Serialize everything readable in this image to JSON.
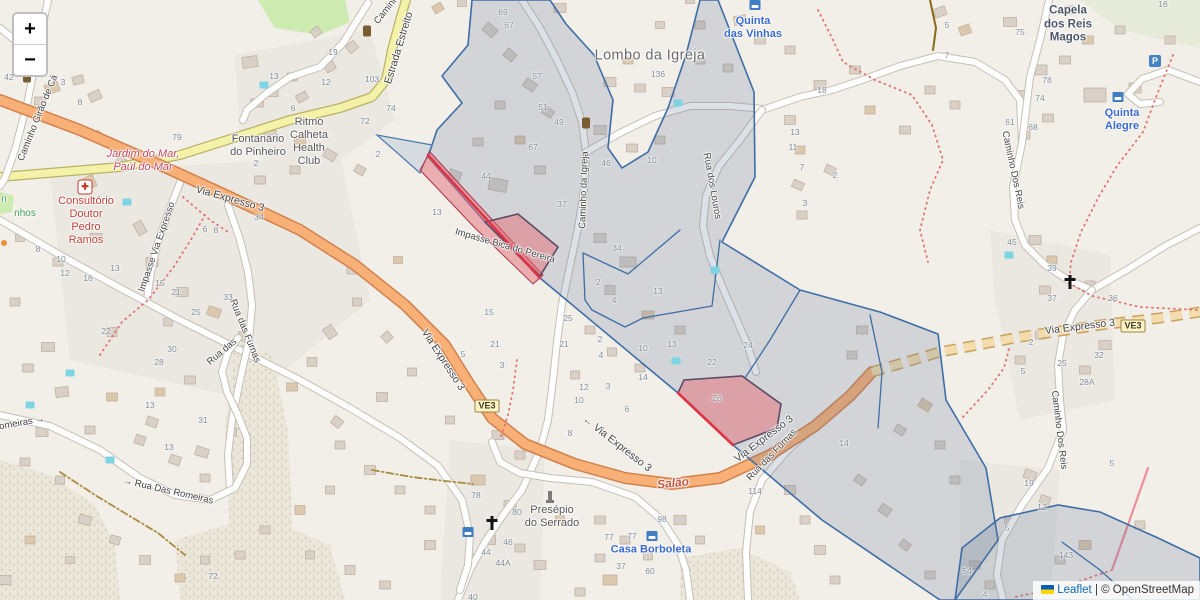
{
  "map_colors": {
    "land": "#f2efe9",
    "overlay_fill": "rgba(96,118,148,0.22)",
    "overlay_stroke": "#3e6da6",
    "flag_fill": "rgba(228,110,120,0.50)",
    "flag_stroke": "#5c4a66",
    "flag_red_edge": "#e03445",
    "trunk_road": "#f8b076",
    "secondary_road": "#f4f2a9",
    "trail_red": "#e4706e",
    "track_tan": "#a98a3f"
  },
  "zoom_control": {
    "zoom_in": "+",
    "zoom_out": "−"
  },
  "attribution": {
    "leaflet": "Leaflet",
    "separator": " | ",
    "copyright": "© OpenStreetMap"
  },
  "road_badges": [
    {
      "text": "VE3",
      "x": 487,
      "y": 406
    },
    {
      "text": "VE3",
      "x": 1133,
      "y": 326
    }
  ],
  "labels": [
    {
      "text": "Lombo da Igreja",
      "x": 650,
      "y": 56,
      "rot": 0,
      "cls": "place"
    },
    {
      "text": "Quinta\ndas Vinhas",
      "x": 753,
      "y": 28,
      "rot": 0,
      "cls": "poi-blue"
    },
    {
      "text": "Capela\ndos Reis\nMagos",
      "x": 1068,
      "y": 25,
      "rot": 0,
      "cls": "poi-dark"
    },
    {
      "text": "Quinta\nAlegre",
      "x": 1122,
      "y": 120,
      "rot": 0,
      "cls": "poi-blue"
    },
    {
      "text": "Casa Borboleta",
      "x": 651,
      "y": 550,
      "rot": 0,
      "cls": "poi-blue"
    },
    {
      "text": "Consultório\nDoutor\nPedro\nRamos",
      "x": 86,
      "y": 221,
      "rot": 0,
      "cls": "poi-red"
    },
    {
      "text": "Jardim do Mar,\nPaúl do Mar",
      "x": 143,
      "y": 161,
      "rot": 0,
      "cls": "boundary"
    },
    {
      "text": "Salão",
      "x": 673,
      "y": 483,
      "rot": -6,
      "cls": "locality"
    },
    {
      "text": "Presépio\ndo Serrado",
      "x": 552,
      "y": 517,
      "rot": 0,
      "cls": "poi-gray"
    },
    {
      "text": "Ritmo\nCalheta\nHealth\nClub",
      "x": 309,
      "y": 142,
      "rot": 0,
      "cls": "poi-gray"
    },
    {
      "text": "Fontanário\ndo Pinheiro",
      "x": 258,
      "y": 146,
      "rot": 0,
      "cls": "poi-gray"
    },
    {
      "text": "n",
      "x": 4,
      "y": 200,
      "rot": 0,
      "cls": "path-green"
    },
    {
      "text": "nhos",
      "x": 25,
      "y": 214,
      "rot": 0,
      "cls": "path-green"
    },
    {
      "text": "Caminho Girão de Cá",
      "x": 38,
      "y": 118,
      "rot": -68,
      "cls": "road"
    },
    {
      "text": "Caminho",
      "x": 388,
      "y": 8,
      "rot": -52,
      "cls": "road"
    },
    {
      "text": "Estrada Estreito",
      "x": 399,
      "y": 48,
      "rot": -73,
      "cls": "road road-lg"
    },
    {
      "text": "Via Expresso 3",
      "x": 230,
      "y": 199,
      "rot": 16,
      "cls": "road road-lg"
    },
    {
      "text": "Impasse Via Expresso",
      "x": 157,
      "y": 247,
      "rot": -71,
      "cls": "road"
    },
    {
      "text": "Via Expresso 3",
      "x": 443,
      "y": 360,
      "rot": 57,
      "cls": "road road-lg"
    },
    {
      "text": "← Via Expresso 3",
      "x": 617,
      "y": 444,
      "rot": 38,
      "cls": "road road-lg"
    },
    {
      "text": "Via Expresso 3",
      "x": 764,
      "y": 439,
      "rot": -37,
      "cls": "road road-lg"
    },
    {
      "text": "Via Expresso 3",
      "x": 1080,
      "y": 327,
      "rot": -7,
      "cls": "road road-lg"
    },
    {
      "text": "Impasse Bica do Pereira",
      "x": 505,
      "y": 246,
      "rot": 16,
      "cls": "road"
    },
    {
      "text": "Caminho da Igreja",
      "x": 584,
      "y": 190,
      "rot": -88,
      "cls": "road"
    },
    {
      "text": "Rua dos Louros",
      "x": 712,
      "y": 186,
      "rot": 80,
      "cls": "road"
    },
    {
      "text": "Caminho Dos Reis",
      "x": 1013,
      "y": 170,
      "rot": 78,
      "cls": "road"
    },
    {
      "text": "Caminho Dos Reis",
      "x": 1059,
      "y": 430,
      "rot": 83,
      "cls": "road"
    },
    {
      "text": "Rua das Furnas",
      "x": 245,
      "y": 331,
      "rot": 68,
      "cls": "road"
    },
    {
      "text": "Rua das Furnas",
      "x": 772,
      "y": 455,
      "rot": -46,
      "cls": "road"
    },
    {
      "text": "→ Rua Das Romeiras",
      "x": 168,
      "y": 491,
      "rot": 13,
      "cls": "road"
    },
    {
      "text": "omeiras →",
      "x": 22,
      "y": 423,
      "rot": -10,
      "cls": "road"
    },
    {
      "text": "Rua das",
      "x": 222,
      "y": 352,
      "rot": -40,
      "cls": "road"
    }
  ],
  "house_numbers": [
    [
      9,
      77,
      "42"
    ],
    [
      63,
      82,
      "3"
    ],
    [
      80,
      102,
      "8"
    ],
    [
      177,
      137,
      "79"
    ],
    [
      256,
      163,
      "2"
    ],
    [
      274,
      76,
      "13"
    ],
    [
      293,
      108,
      "6"
    ],
    [
      333,
      52,
      "19"
    ],
    [
      326,
      82,
      "12"
    ],
    [
      372,
      79,
      "103"
    ],
    [
      391,
      108,
      "74"
    ],
    [
      365,
      121,
      "72"
    ],
    [
      378,
      154,
      "2"
    ],
    [
      503,
      12,
      "69"
    ],
    [
      509,
      25,
      "67"
    ],
    [
      537,
      76,
      "57"
    ],
    [
      543,
      107,
      "51"
    ],
    [
      559,
      122,
      "49"
    ],
    [
      533,
      147,
      "67"
    ],
    [
      658,
      74,
      "136"
    ],
    [
      606,
      163,
      "46"
    ],
    [
      652,
      160,
      "10"
    ],
    [
      822,
      90,
      "18"
    ],
    [
      795,
      132,
      "13"
    ],
    [
      793,
      147,
      "11"
    ],
    [
      802,
      167,
      "7"
    ],
    [
      835,
      175,
      "2"
    ],
    [
      805,
      203,
      "3"
    ],
    [
      486,
      176,
      "44"
    ],
    [
      437,
      212,
      "13"
    ],
    [
      562,
      204,
      "37"
    ],
    [
      617,
      248,
      "34"
    ],
    [
      598,
      282,
      "2"
    ],
    [
      614,
      300,
      "4"
    ],
    [
      658,
      291,
      "13"
    ],
    [
      568,
      318,
      "25"
    ],
    [
      564,
      344,
      "21"
    ],
    [
      600,
      339,
      "2"
    ],
    [
      601,
      355,
      "4"
    ],
    [
      643,
      348,
      "10"
    ],
    [
      672,
      344,
      "13"
    ],
    [
      712,
      362,
      "22"
    ],
    [
      643,
      377,
      "14"
    ],
    [
      748,
      345,
      "24"
    ],
    [
      627,
      409,
      "6"
    ],
    [
      608,
      386,
      "3"
    ],
    [
      584,
      387,
      "12"
    ],
    [
      579,
      400,
      "10"
    ],
    [
      717,
      398,
      "26"
    ],
    [
      489,
      312,
      "15"
    ],
    [
      495,
      344,
      "21"
    ],
    [
      463,
      354,
      "5"
    ],
    [
      502,
      365,
      "3"
    ],
    [
      38,
      249,
      "8"
    ],
    [
      61,
      259,
      "10"
    ],
    [
      65,
      273,
      "12"
    ],
    [
      88,
      278,
      "16"
    ],
    [
      115,
      268,
      "13"
    ],
    [
      205,
      229,
      "6"
    ],
    [
      216,
      230,
      "8"
    ],
    [
      259,
      217,
      "34"
    ],
    [
      176,
      292,
      "21"
    ],
    [
      160,
      283,
      "15"
    ],
    [
      196,
      312,
      "25"
    ],
    [
      228,
      297,
      "33"
    ],
    [
      106,
      331,
      "22"
    ],
    [
      172,
      349,
      "30"
    ],
    [
      159,
      362,
      "28"
    ],
    [
      150,
      405,
      "13"
    ],
    [
      203,
      420,
      "31"
    ],
    [
      169,
      447,
      "13"
    ],
    [
      213,
      576,
      "72"
    ],
    [
      570,
      433,
      "8"
    ],
    [
      476,
      495,
      "78"
    ],
    [
      517,
      512,
      "80"
    ],
    [
      508,
      542,
      "46"
    ],
    [
      486,
      552,
      "44"
    ],
    [
      503,
      563,
      "44A"
    ],
    [
      473,
      597,
      "40"
    ],
    [
      662,
      519,
      "98"
    ],
    [
      609,
      537,
      "77"
    ],
    [
      632,
      536,
      "77"
    ],
    [
      621,
      566,
      "37"
    ],
    [
      650,
      571,
      "60"
    ],
    [
      755,
      491,
      "114"
    ],
    [
      844,
      443,
      "14"
    ],
    [
      1012,
      242,
      "45"
    ],
    [
      1052,
      268,
      "39"
    ],
    [
      1052,
      298,
      "37"
    ],
    [
      1113,
      298,
      "36"
    ],
    [
      1031,
      342,
      "2"
    ],
    [
      1062,
      363,
      "25"
    ],
    [
      1023,
      371,
      "5"
    ],
    [
      1099,
      355,
      "32"
    ],
    [
      1087,
      382,
      "28A"
    ],
    [
      1029,
      483,
      "19"
    ],
    [
      1042,
      507,
      "12"
    ],
    [
      1007,
      528,
      "5"
    ],
    [
      1112,
      463,
      "5"
    ],
    [
      1066,
      555,
      "143"
    ],
    [
      967,
      571,
      "54"
    ],
    [
      985,
      594,
      "4"
    ],
    [
      1047,
      80,
      "78"
    ],
    [
      1040,
      98,
      "74"
    ],
    [
      1010,
      122,
      "61"
    ],
    [
      1033,
      127,
      "68"
    ],
    [
      947,
      25,
      "5"
    ],
    [
      947,
      55,
      "7"
    ],
    [
      1020,
      32,
      "75"
    ],
    [
      1163,
      4,
      "16"
    ]
  ],
  "icons": [
    {
      "type": "waste",
      "x": 27,
      "y": 78
    },
    {
      "type": "waste",
      "x": 367,
      "y": 32
    },
    {
      "type": "waste",
      "x": 586,
      "y": 124
    },
    {
      "type": "hospital",
      "x": 85,
      "y": 187
    },
    {
      "type": "cross",
      "x": 492,
      "y": 523
    },
    {
      "type": "cross",
      "x": 1070,
      "y": 282
    },
    {
      "type": "parking",
      "x": 1155,
      "y": 61
    },
    {
      "type": "guest",
      "x": 468,
      "y": 532
    },
    {
      "type": "guest",
      "x": 652,
      "y": 536
    },
    {
      "type": "guest",
      "x": 1118,
      "y": 97
    },
    {
      "type": "guest",
      "x": 755,
      "y": 5
    },
    {
      "type": "statue",
      "x": 550,
      "y": 497
    },
    {
      "type": "shop-dot",
      "x": 4,
      "y": 243
    },
    {
      "type": "pool",
      "x": 264,
      "y": 85
    },
    {
      "type": "pool",
      "x": 127,
      "y": 202
    },
    {
      "type": "pool",
      "x": 678,
      "y": 103
    },
    {
      "type": "pool",
      "x": 1009,
      "y": 255
    },
    {
      "type": "pool",
      "x": 70,
      "y": 373
    },
    {
      "type": "pool",
      "x": 30,
      "y": 405
    },
    {
      "type": "pool",
      "x": 110,
      "y": 460
    },
    {
      "type": "pool",
      "x": 715,
      "y": 270
    },
    {
      "type": "pool",
      "x": 676,
      "y": 361
    }
  ]
}
